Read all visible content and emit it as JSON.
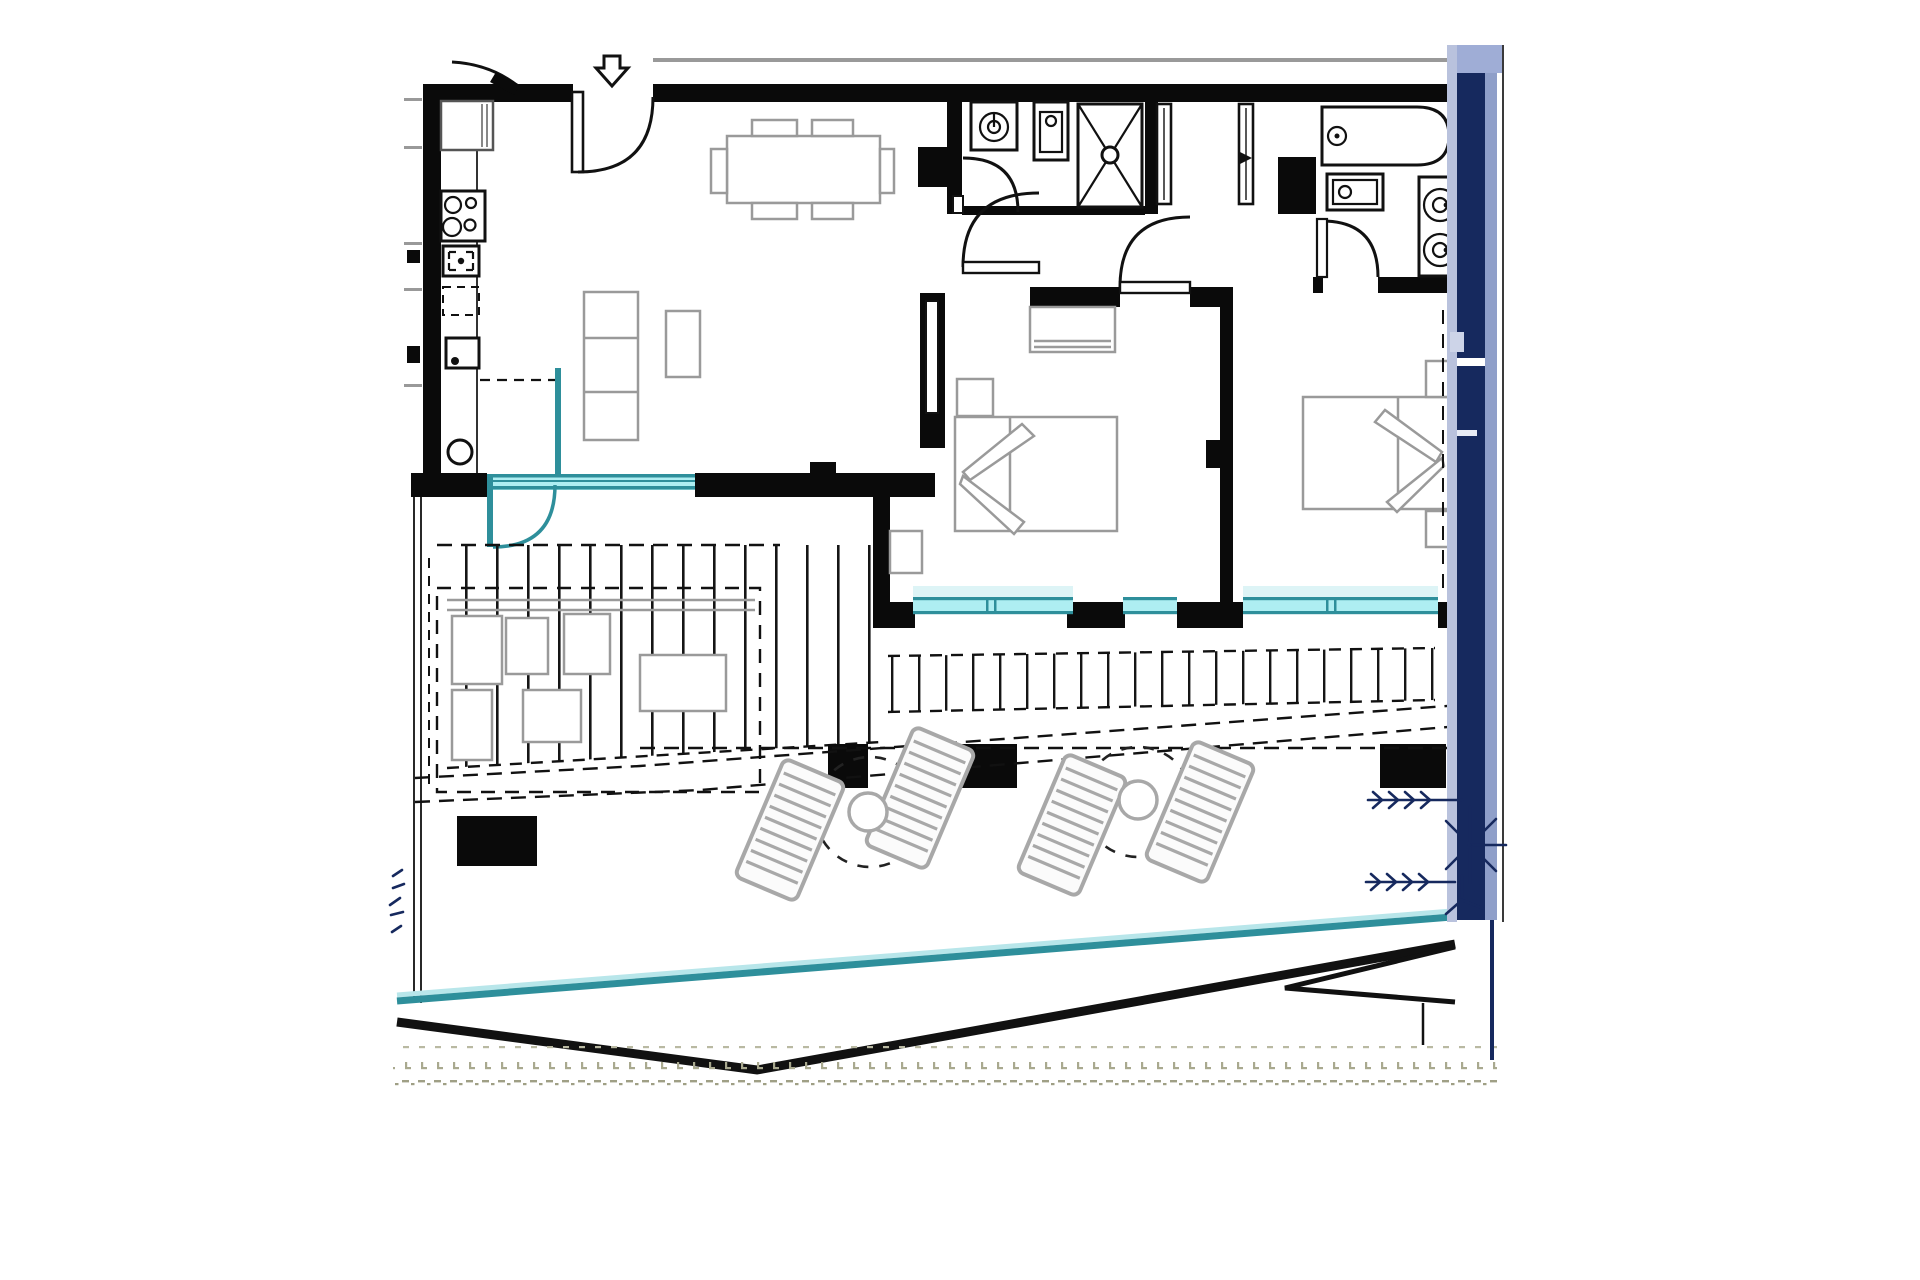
{
  "colors": {
    "background": "#ffffff",
    "wall": "#0a0a0a",
    "furniture_gray": "#9a9a9a",
    "lounger_gray": "#a8a8a8",
    "glass_teal": "#2e8f9b",
    "glass_teal_light": "#aeeef2",
    "glass_glow": "#ddf4f6",
    "water_hint": "#d6f0f3",
    "navy": "#16295e",
    "navy_light": "#8f9fc9",
    "lavender": "#b9c2dd",
    "texture_olive": "#a9a98f"
  }
}
